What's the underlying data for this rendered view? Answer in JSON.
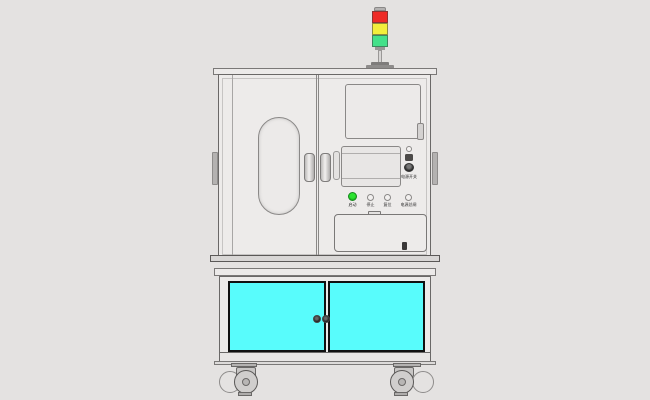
{
  "scene": {
    "description": "CAD rendering of an industrial test-equipment cabinet on a caster cart",
    "background_color": "#e4e2e1"
  },
  "signal_tower": {
    "lights": [
      {
        "name": "red",
        "color": "#ee2b26"
      },
      {
        "name": "yellow",
        "color": "#f2ef3c"
      },
      {
        "name": "green",
        "color": "#44e18a"
      }
    ]
  },
  "control_panel": {
    "power_label": "电源开关",
    "buttons": [
      {
        "label": "启动",
        "color": "#2ce331",
        "style": "green-illuminated"
      },
      {
        "label": "停止",
        "color": "#f2f0ef",
        "style": "round"
      },
      {
        "label": "复位",
        "color": "#f2f0ef",
        "style": "round"
      },
      {
        "label": "电源总闸",
        "color": "#f2f0ef",
        "style": "round"
      }
    ]
  },
  "lower_cabinet": {
    "door_color": "#58fcfc",
    "door_count": 2
  },
  "colors": {
    "body": "#edebea",
    "outline": "#6a6867",
    "cyan_doors": "#58fcfc",
    "background": "#e4e2e1"
  }
}
